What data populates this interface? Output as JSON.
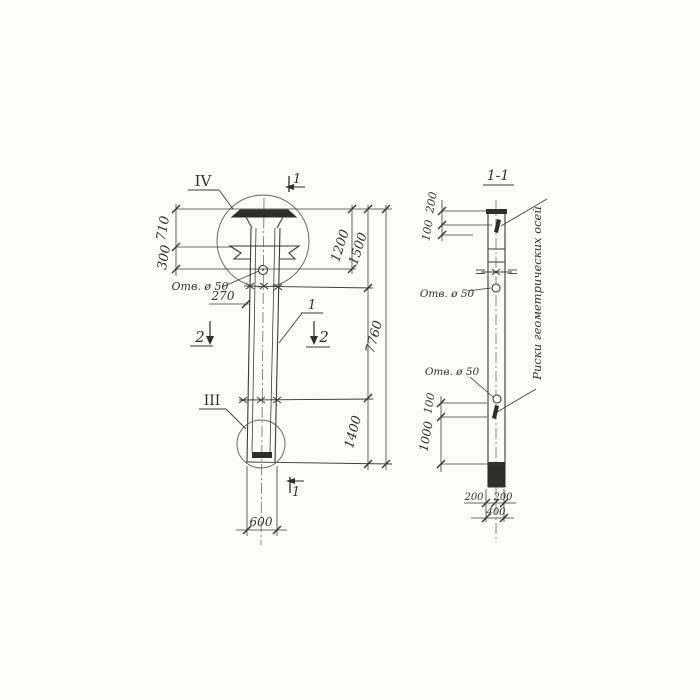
{
  "ink": "#3a3a38",
  "views": {
    "elevation": {
      "detail_iv": "IV",
      "detail_iii": "III",
      "cut1_top": "1",
      "cut1_bottom": "1",
      "cut2_left": "2",
      "cut2_right": "2",
      "pos1": "1",
      "hole_label": "Отв. ø 50",
      "dims": {
        "h710": "710",
        "h300": "300",
        "h270": "270",
        "h1200": "1200",
        "h1500": "1500",
        "h1400": "1400",
        "h7760": "7760",
        "w600": "600"
      }
    },
    "section": {
      "title": "1-1",
      "hole_label_top": "Отв. ø 50",
      "hole_label_bottom": "Отв. ø 50",
      "axis_note": "Риски геометрических осей",
      "dims": {
        "t200": "200",
        "t100": "100",
        "b100": "100",
        "b1000": "1000",
        "bl200": "200",
        "br200": "200",
        "w400": "400"
      }
    }
  }
}
